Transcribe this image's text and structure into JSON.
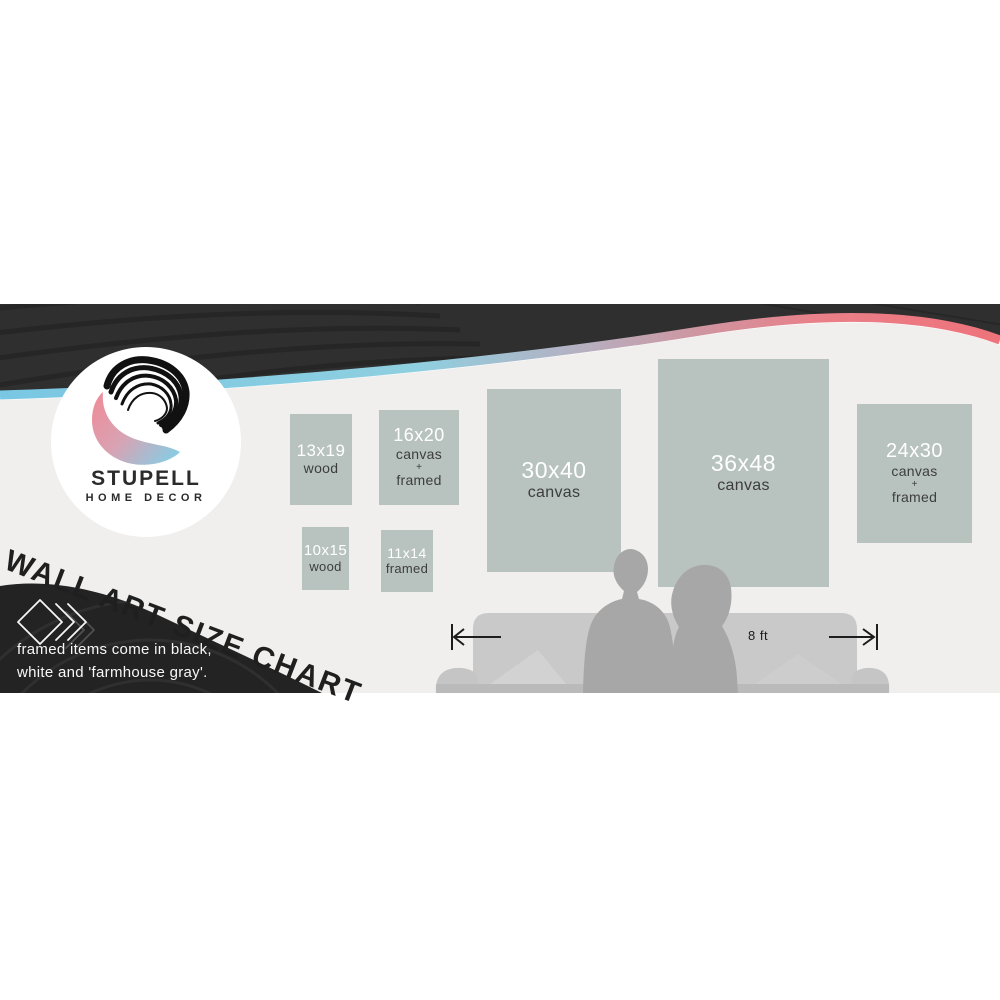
{
  "banner": {
    "brand": {
      "line1": "STUPELL",
      "line2": "HOME DECOR"
    },
    "headline": "WALL ART SIZE CHART",
    "note": {
      "line1": "framed items come in black,",
      "line2": "white and 'farmhouse gray'."
    },
    "measurement": {
      "label": "8 ft"
    }
  },
  "size_boxes": [
    {
      "size": "13x19",
      "lines": [
        "wood"
      ]
    },
    {
      "size": "16x20",
      "lines": [
        "canvas",
        "+",
        "framed"
      ]
    },
    {
      "size": "10x15",
      "lines": [
        "wood"
      ]
    },
    {
      "size": "11x14",
      "lines": [
        "framed"
      ]
    },
    {
      "size": "30x40",
      "lines": [
        "canvas"
      ]
    },
    {
      "size": "36x48",
      "lines": [
        "canvas"
      ]
    },
    {
      "size": "24x30",
      "lines": [
        "canvas",
        "+",
        "framed"
      ]
    }
  ],
  "colors": {
    "ink_black": "#2f2f2f",
    "bg_light": "#f0efee",
    "panel_sage": "#b8c3c0",
    "accent_cyan": "#79c7e3",
    "accent_coral": "#ee737b",
    "logo_pink": "#ee8c99",
    "logo_blue": "#7fd0e8"
  }
}
